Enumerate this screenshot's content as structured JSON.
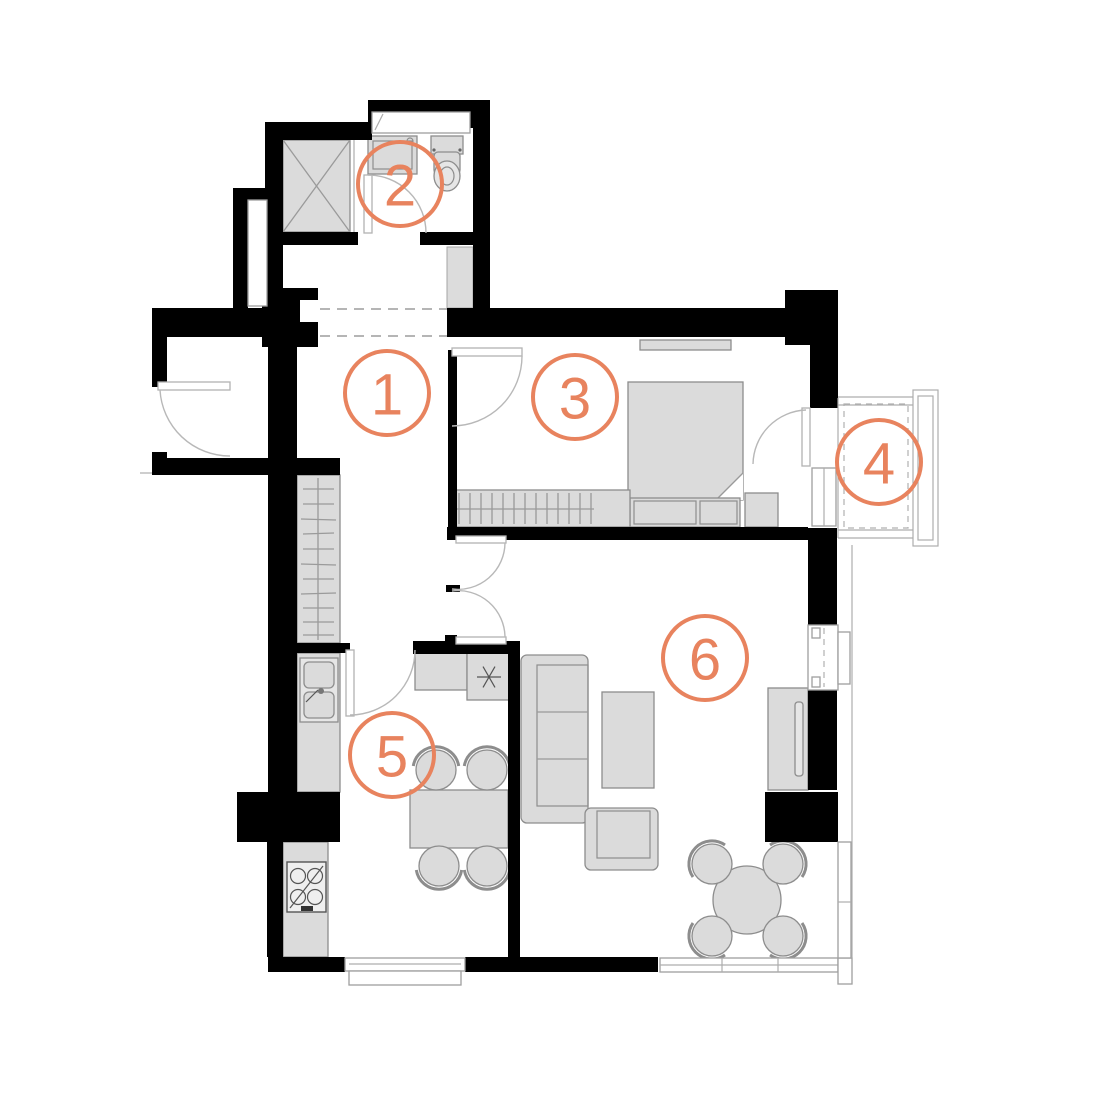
{
  "colors": {
    "accent": "#E8835E",
    "wall": "#000000",
    "furniture": "#DBDBDB",
    "line": "#9A9A9A"
  },
  "rooms": [
    {
      "number": "1"
    },
    {
      "number": "2"
    },
    {
      "number": "3"
    },
    {
      "number": "4"
    },
    {
      "number": "5"
    },
    {
      "number": "6"
    }
  ]
}
